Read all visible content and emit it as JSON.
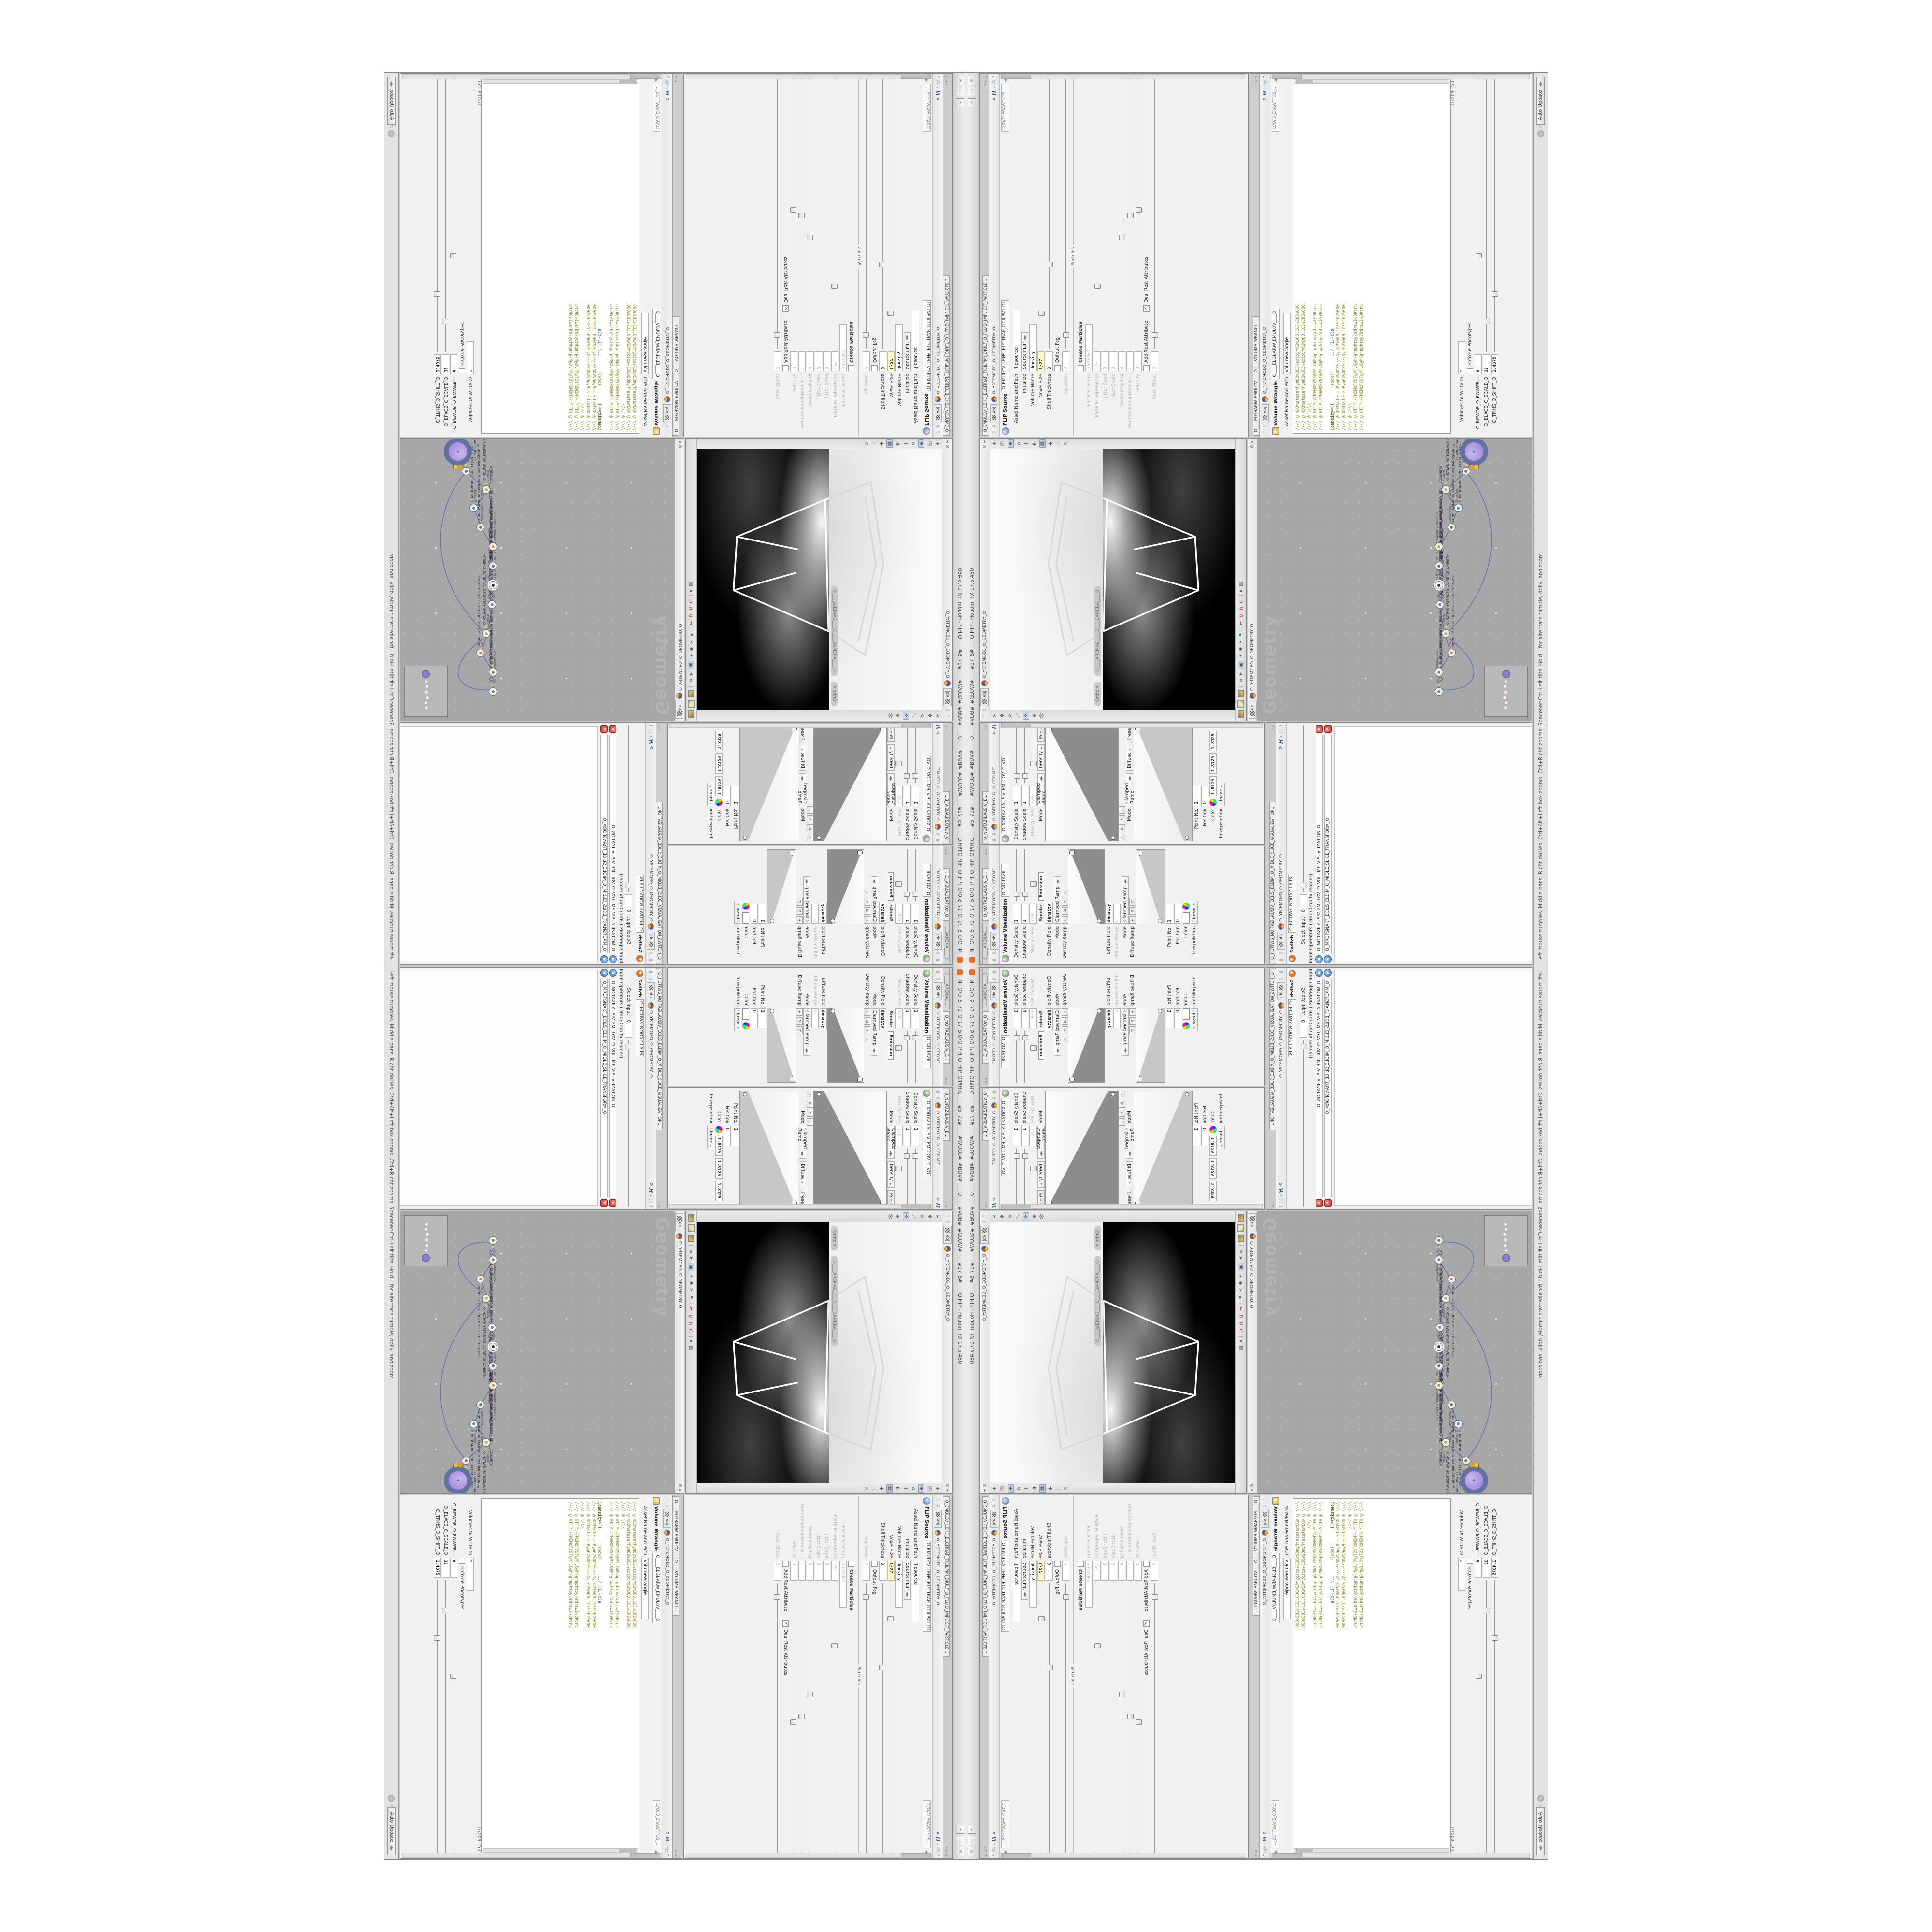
{
  "window": {
    "title": "INI_O/O_5_71_O_17_5.O/O_PIH_O_HIP_O/PIH.Q____#5_71#____#WOLG#_#BDV#____O____#VDB#_#GLOW#____#17_5#____Q.HIP - Houdini FX 17.5.480",
    "minimize": "–",
    "maximize": "□",
    "close": "✕",
    "status_left": "Left mouse tumbles. Middle pans. Right dollies. Ctrl+Alt+Left box-zooms. Ctrl+Right zooms. Spacebar-Ctrl-Left tilts. Hold L for alternate tumble, dolly, and zoom.",
    "auto_update": "Auto Update"
  },
  "chrome": {
    "obj_chip": "obj",
    "breadcrumb": "O_YRTEMOEG_O_GEOMETRY_O",
    "hda_path": "C:/O/O_ERAWTFOS_...",
    "accent_orange": "#e8731d",
    "code_olive": "#8f8f25",
    "net_bg": "#a7a7a7"
  },
  "volviz": {
    "tab_camera": "O____AREMAC____O...",
    "tab_self": "O_NOITAZILAUSIV_E...",
    "title": "Volume Visualization",
    "name_small": "O_NOITAZIL...",
    "name_big": "O_NOITAZILAUSIV_EMULOV_O_VO",
    "density_scale_label": "Density Scale",
    "density_scale": "1",
    "shadow_scale_label": "Shadow Scale",
    "shadow_scale": "1",
    "maxvis_label": "Max Vis Res",
    "maxvis": "128",
    "smoke": "Smoke",
    "emission": "Emission",
    "density_field_label": "Density Field",
    "density_field": "density",
    "mode_label": "Mode",
    "mode": "Clamped Ramp",
    "density_chip": "Density",
    "diffuse_chip": "Diffuse",
    "presets": "Presets",
    "density_ramp_label": "Density Ramp",
    "diffuse_field_label": "Diffuse Field",
    "diffuse_field": "density",
    "diffuse_range_label": "Diffuse Range",
    "diffuse_range": "0",
    "diffuse_ramp_label": "Diffuse Ramp",
    "point_label": "Point No.",
    "point": "1",
    "position_label": "Position",
    "position": "0",
    "color_label": "Color",
    "color_r": "1.8125",
    "color_g": "1.8125",
    "color_b": "1.8125",
    "interp_label": "Interpolation",
    "interp": "Linear"
  },
  "switch": {
    "tab": "O_HCTIWS_NOITAZILAUSIV_ECILS_ELDIM_O_MIDLE_SLICE_VISUALIZATION...",
    "title": "Switch",
    "name": "O_HCTIWS_NOITAZILAUS",
    "select_input_label": "Select Input",
    "select_input": "0",
    "operators_label": "Input Operators (Drag/Drop to reorder)",
    "op1": "O_NOITAZILAUSIV_EMULOV_O_VOLUME_VISUALIZATION_O",
    "op2": "O_MROFSNART_ECILS_ELDIM_O_MIDLE_SLICE_TRANSFORM_O",
    "reorder_glyph": "◀",
    "remove_glyph": "✕"
  },
  "viewport": {
    "ortho": "Ortho ▾",
    "camera": "O____AREMAC____O____CAMERA____O"
  },
  "network": {
    "path": "O_YRTEMOEG_O_GEOMETRY_O",
    "watermark": "Geometry",
    "nodes": [
      {
        "type": "an_CubeSphere",
        "name": "O_EREHPS_EBUC_O_CUBE_SPHERE_O"
      },
      {
        "type": "PolyWire",
        "name": "O_EMARFERIW_NOGYLOP_EREHPS_EBUC_O_CUBE_SPHERE_POLYGON_WIREFRAME_O"
      },
      {
        "type": "File",
        "name": "JBO.AD3.PETS.TRPDLS_O_GLB.SLDPRT.STEP.3DA.OBJ"
      },
      {
        "type": "Switch",
        "name": "O_HCTIWS_YRTEMOEG_LANRETXE_LANRETNI_O_INTERNAL_EXTERNAL_GEOMETRY_SWITCH_O"
      },
      {
        "type": "Clip",
        "name": "O_PILC_ECILS_ELDIM_O_MIDLE_SLICE_CLIP_O"
      },
      {
        "type": "FLIP Source",
        "name": "O_EMULOV_LEHS_ELCITRAP_TICILPMI_DIULF_O_FLUID_IMPLICIT_PARTICLE_SHEL_VOLUME_O"
      },
      {
        "type": "VDB from Polygons",
        "name": "O_SNOGILOP_YRTEMOEG_MORF_EMULOV_BDV_O_VDB_VOLUME_FROM_GEOMETRY_POLYG..."
      },
      {
        "type": "Volume Wrangle",
        "name": "O____ELGNARW_EMULOV____O____VOLUME_WRANGLE___O"
      },
      {
        "type": "VolumeVisualization",
        "name": "O_NOITAZILAUSIV_EMULOV_O_VOLUME_VISUALIZATION_O"
      },
      {
        "type": "Transform",
        "name": "O_MROFSNART_ECILS_ELDIM_O_MIDLE_SLICE_TRANSFORM_O"
      },
      {
        "type": "Switch",
        "name": "O_HCTIWS_NOITAZILAUSIV_ECILS_ELDIM_O_MIDLE_SLICE_VISUALIZATION_SWITCH_O"
      },
      {
        "type": "Merge",
        "name": "O_ECAFRUS_HTIW_EMULOV_EGREM_O_MERGE_VOLUME_WITH_SURFACE_O"
      },
      {
        "type": "Transform",
        "name": "O_MROFSNART_TLUSER_O_RESULT_TRANSFORM_O"
      }
    ]
  },
  "flip": {
    "tab": "O_EMULOV_LEHS_ELCITRAP_TICILPMI_DIULF_O_FLUID_IMPLICIT_PARTICLE...",
    "title": "FLIP Source",
    "name": "O_EMULOV_LEHS_ELCITRAP_TICILPMI_DI",
    "asset_label": "Asset Name and Path",
    "asset": "flipsource",
    "initialize_label": "Initialize",
    "initialize": "Source FLIP",
    "volume_name_label": "Volume Name",
    "volume_name": "density",
    "voxel_size_label": "Voxel Size",
    "voxel_size": "1/27",
    "shell_label": "Shell Thickness",
    "shell": "3",
    "output_fog_label": "Output Fog",
    "fog_boost_label": "Fog Boost",
    "fog_boost": "0",
    "particles_group": "Particles",
    "create_particles_label": "Create Particles",
    "particle_group_label": "Particle Group",
    "particle_group": "particles",
    "particle_sep_label": "Particle Separation",
    "particle_sep": "1/9",
    "jitter_seed_label": "Jitter Seed",
    "jitter_seed": "0",
    "jitter_scale_label": "Jitter Scale",
    "jitter_scale": "0",
    "oversampling_label": "Oversampling",
    "oversampling": "2",
    "oversampling_bw_label": "Oversampling Bandwi...",
    "oversampling_bw": "1",
    "velocity_label": "Velocity",
    "velocity": "0",
    "add_rest_label": "Add Rest Attribute",
    "dual_rest_label": "Dual Rest Attributes",
    "rest_offset_label": "Rest Offset",
    "rest_offset": "0",
    "check_glyph": "✓"
  },
  "wrangle": {
    "tab": "O____ELGNARW_EMULOV____O____VOLUME_WRANGL...",
    "title": "Volume Wrangle",
    "name": "O____ELGNARW_EMULOV____O",
    "asset_label": "Asset Name and Path",
    "asset": "volumewrangle",
    "code": [
      "//// @ 0D3%steserPym62%0D3%eziSym62%000.1D3%C62%000.",
      "//// @ 0D3%steserPym62%0D3%eziSym62%000.1D3%C62%000.",
      "//// @ \\\\\\\\",
      "//// @ HTTP://MEMORYST@MP.C@M/graphtoy/#draw1%3Dtru",
      "//// @ HTTP://MEMORYST@MP.C@M/graphtoy/#draw1%3Dtru",
      ""
    ],
    "density_a": "@density=((",
    "density_b": "      ((pow((",
    "density_c": "      1./ (1.-cla",
    "code2": [
      "",
      "//// @ 0D3%steserPym62%0D3%eziSym62%000.1D3%C62%000.",
      "//// @ 0D3%steserPym62%0D3%eziSym62%000.1D3%C62%000.",
      "//// @ \\\\\\\\",
      "//// @ HTTP://MEMORYST@MP.C@M/graphtoy/#draw1%3Dtru",
      "//// @ HTTP://MEMORYST@MP.C@M/graphtoy/#draw1%3Dtru"
    ],
    "lncol": "Ln 209, Col 1",
    "volumes_label": "Volumes to Write to",
    "volumes": "*",
    "enforce_label": "Enforce Prototypes",
    "power_label": "O_REWOP_O_POWER...",
    "power": "6",
    "scale_label": "O_ELACS_O_SCALE_O",
    "scale": "32",
    "shift_label": "O_TFIHS_O_SHIFT_O",
    "shift": "1.4375"
  }
}
